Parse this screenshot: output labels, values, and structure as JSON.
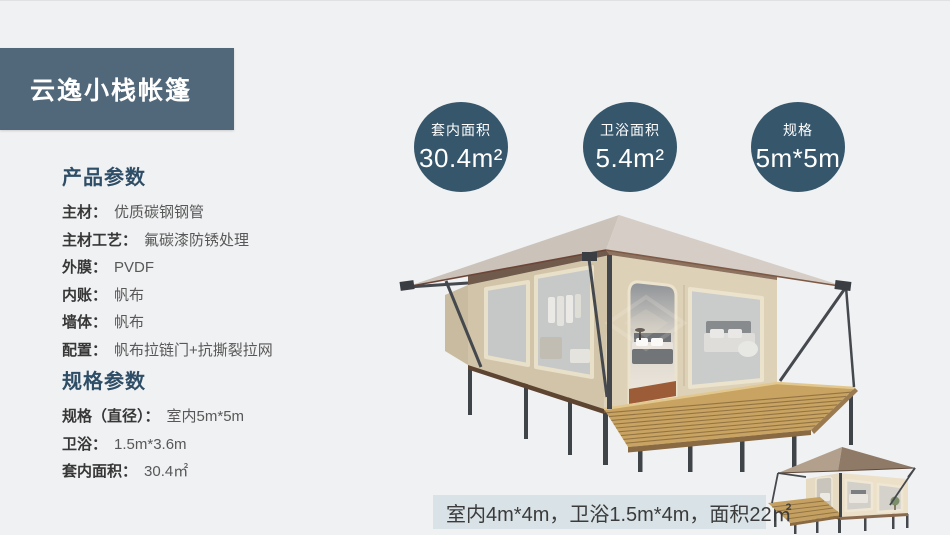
{
  "header": {
    "title": "云逸小栈帐篷"
  },
  "sidebar": {
    "sections": [
      {
        "heading": "产品参数",
        "items": [
          {
            "label": "主材：",
            "value": "优质碳钢钢管"
          },
          {
            "label": "主材工艺：",
            "value": "氟碳漆防锈处理"
          },
          {
            "label": "外膜：",
            "value": "PVDF"
          },
          {
            "label": "内账：",
            "value": "帆布"
          },
          {
            "label": "墙体：",
            "value": "帆布"
          },
          {
            "label": "配置：",
            "value": "帆布拉链门+抗撕裂拉网"
          }
        ]
      },
      {
        "heading": "规格参数",
        "items": [
          {
            "label": "规格（直径）：",
            "value": "室内5m*5m"
          },
          {
            "label": "卫浴：",
            "value": "1.5m*3.6m"
          },
          {
            "label": "套内面积：",
            "value": "30.4㎡"
          }
        ]
      }
    ]
  },
  "badges": [
    {
      "label": "套内面积",
      "value": "30.4m²"
    },
    {
      "label": "卫浴面积",
      "value": "5.4m²"
    },
    {
      "label": "规格",
      "value": "5m*5m"
    }
  ],
  "caption": {
    "text": "室内4m*4m，卫浴1.5m*4m，面积22㎡"
  },
  "colors": {
    "background": "#f0f1f2",
    "accent": "#51677a",
    "badge": "#36566b",
    "caption_bg": "#d9e3e7",
    "heading_text": "#2e4d66"
  }
}
